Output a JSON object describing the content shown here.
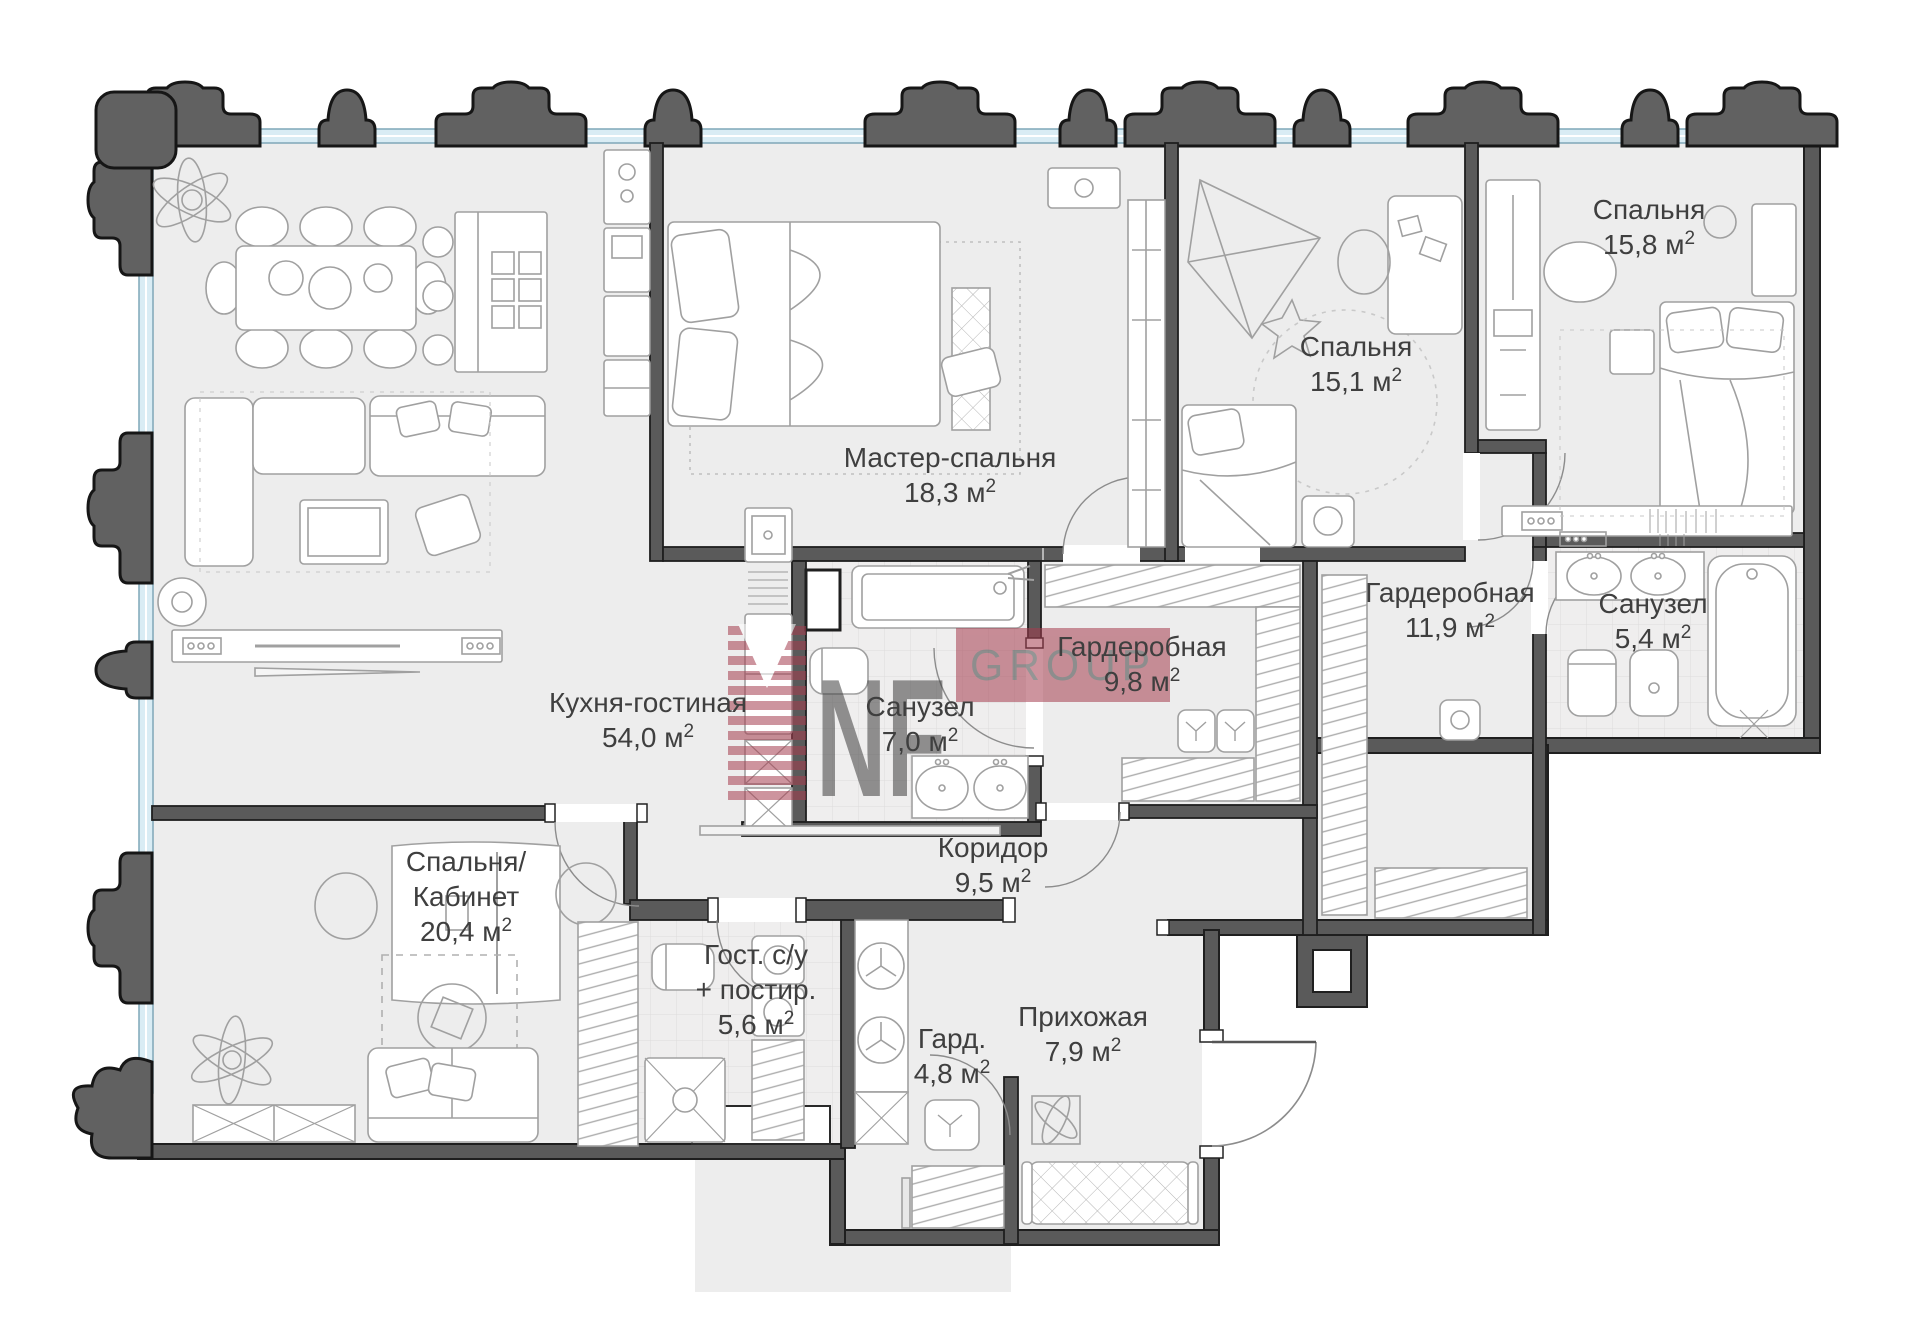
{
  "plan": {
    "type": "apartment-floor-plan",
    "units": "м2"
  },
  "watermark": {
    "letters": "NF",
    "band_text": "GROUP",
    "color": "#a63d4f"
  },
  "colors": {
    "wall": "#5a5a5a",
    "wall_outline": "#1f1f1f",
    "floor": "#ededed",
    "bath_floor": "#f0efef",
    "glazing": "#d9ecf4",
    "furniture_stroke": "#a0a0a0",
    "label_text": "#3f3f3f",
    "watermark_red": "#a63d4f"
  },
  "rooms": [
    {
      "id": "kitchen-living",
      "name_lines": [
        "Кухня-гостиная"
      ],
      "area": "54,0",
      "label": {
        "x": 648,
        "y": 712
      }
    },
    {
      "id": "master-bedroom",
      "name_lines": [
        "Мастер-спальня"
      ],
      "area": "18,3",
      "label": {
        "x": 950,
        "y": 467
      }
    },
    {
      "id": "bedroom-2",
      "name_lines": [
        "Спальня"
      ],
      "area": "15,1",
      "label": {
        "x": 1356,
        "y": 356
      }
    },
    {
      "id": "bedroom-3",
      "name_lines": [
        "Спальня"
      ],
      "area": "15,8",
      "label": {
        "x": 1649,
        "y": 219
      }
    },
    {
      "id": "wardrobe-9-8",
      "name_lines": [
        "Гардеробная"
      ],
      "area": "9,8",
      "label": {
        "x": 1142,
        "y": 656
      }
    },
    {
      "id": "wardrobe-11-9",
      "name_lines": [
        "Гардеробная"
      ],
      "area": "11,9",
      "label": {
        "x": 1450,
        "y": 602
      }
    },
    {
      "id": "bathroom-7-0",
      "name_lines": [
        "Санузел"
      ],
      "area": "7,0",
      "label": {
        "x": 920,
        "y": 716
      }
    },
    {
      "id": "bathroom-5-4",
      "name_lines": [
        "Санузел"
      ],
      "area": "5,4",
      "label": {
        "x": 1653,
        "y": 613
      }
    },
    {
      "id": "corridor",
      "name_lines": [
        "Коридор"
      ],
      "area": "9,5",
      "label": {
        "x": 993,
        "y": 857
      }
    },
    {
      "id": "bedroom-office",
      "name_lines": [
        "Спальня/",
        "Кабинет"
      ],
      "area": "20,4",
      "label": {
        "x": 466,
        "y": 871
      }
    },
    {
      "id": "guest-wc",
      "name_lines": [
        "Гост. с/у",
        "+ постир."
      ],
      "area": "5,6",
      "label": {
        "x": 756,
        "y": 964
      }
    },
    {
      "id": "small-wardrobe",
      "name_lines": [
        "Гард."
      ],
      "area": "4,8",
      "label": {
        "x": 952,
        "y": 1048
      }
    },
    {
      "id": "hallway",
      "name_lines": [
        "Прихожая"
      ],
      "area": "7,9",
      "label": {
        "x": 1083,
        "y": 1026
      }
    }
  ]
}
